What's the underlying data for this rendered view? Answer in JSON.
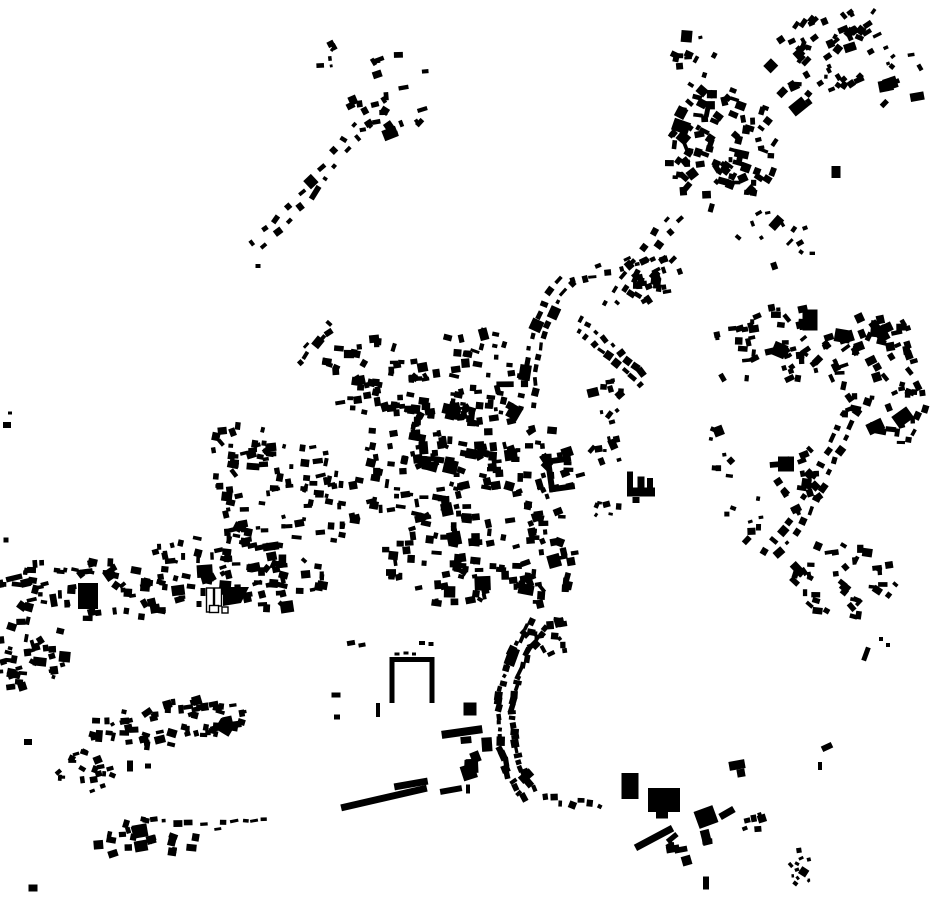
{
  "canvas": {
    "width": 930,
    "height": 924,
    "background": "#ffffff"
  },
  "colors": {
    "building": "#000000",
    "outline_fill": "#ffffff",
    "outline_stroke": "#000000"
  },
  "map": {
    "seed": 42,
    "blob_fields": [
      "cx",
      "cy",
      "rx",
      "ry",
      "count",
      "size",
      "grain_deg",
      "jitter_deg",
      "ellipse_rot_deg"
    ],
    "blobs": [
      [
        392,
        100,
        42,
        48,
        26,
        6,
        -20,
        25,
        20
      ],
      [
        327,
        57,
        12,
        18,
        6,
        4.5,
        -20,
        25,
        0
      ],
      [
        695,
        58,
        22,
        30,
        12,
        5,
        10,
        25,
        0
      ],
      [
        722,
        148,
        58,
        62,
        95,
        6,
        15,
        28,
        10
      ],
      [
        818,
        60,
        52,
        46,
        48,
        6,
        -40,
        20,
        -40
      ],
      [
        858,
        28,
        26,
        20,
        14,
        5.5,
        -40,
        18,
        -40
      ],
      [
        893,
        72,
        32,
        38,
        12,
        5,
        -30,
        25,
        0
      ],
      [
        775,
        240,
        45,
        35,
        12,
        5,
        -30,
        30,
        0
      ],
      [
        652,
        280,
        32,
        28,
        26,
        6,
        -20,
        30,
        0
      ],
      [
        600,
        390,
        25,
        30,
        12,
        5,
        -25,
        30,
        0
      ],
      [
        605,
        452,
        16,
        20,
        8,
        5,
        -20,
        30,
        0
      ],
      [
        606,
        508,
        14,
        10,
        6,
        4.5,
        0,
        30,
        0
      ],
      [
        770,
        348,
        62,
        42,
        50,
        6,
        -15,
        25,
        -12
      ],
      [
        878,
        372,
        50,
        60,
        60,
        6.5,
        -10,
        30,
        0
      ],
      [
        912,
        425,
        16,
        30,
        8,
        5.5,
        0,
        25,
        0
      ],
      [
        800,
        480,
        30,
        35,
        20,
        6,
        -20,
        30,
        0
      ],
      [
        845,
        578,
        52,
        40,
        42,
        6,
        20,
        30,
        0
      ],
      [
        742,
        505,
        22,
        38,
        9,
        5,
        0,
        25,
        0
      ],
      [
        722,
        448,
        20,
        22,
        7,
        4.5,
        0,
        30,
        0
      ],
      [
        382,
        378,
        62,
        40,
        55,
        6,
        0,
        14,
        5
      ],
      [
        488,
        392,
        42,
        36,
        38,
        6,
        0,
        14,
        0
      ],
      [
        475,
        345,
        40,
        16,
        12,
        5.5,
        0,
        20,
        0
      ],
      [
        428,
        462,
        76,
        62,
        120,
        6,
        0,
        14,
        0
      ],
      [
        286,
        498,
        78,
        58,
        95,
        6,
        0,
        14,
        0
      ],
      [
        246,
        445,
        40,
        22,
        18,
        5.5,
        0,
        16,
        0
      ],
      [
        462,
        556,
        78,
        50,
        80,
        6,
        0,
        14,
        0
      ],
      [
        540,
        470,
        42,
        55,
        45,
        6,
        -8,
        16,
        0
      ],
      [
        545,
        560,
        35,
        45,
        35,
        6,
        -8,
        16,
        0
      ],
      [
        552,
        638,
        24,
        20,
        14,
        6,
        -10,
        20,
        0
      ],
      [
        196,
        556,
        42,
        26,
        26,
        5.5,
        0,
        18,
        0
      ],
      [
        92,
        590,
        92,
        30,
        70,
        6,
        0,
        16,
        3
      ],
      [
        262,
        582,
        72,
        28,
        50,
        6,
        0,
        16,
        0
      ],
      [
        32,
        658,
        36,
        46,
        38,
        5.5,
        0,
        20,
        10
      ],
      [
        166,
        723,
        80,
        22,
        65,
        6,
        0,
        18,
        -6
      ],
      [
        86,
        770,
        28,
        22,
        20,
        5,
        0,
        25,
        0
      ],
      [
        150,
        838,
        55,
        20,
        26,
        6,
        0,
        25,
        -4
      ],
      [
        474,
        755,
        16,
        19,
        7,
        10,
        0,
        10,
        0
      ],
      [
        753,
        822,
        16,
        12,
        6,
        6,
        -20,
        20,
        0
      ],
      [
        690,
        845,
        22,
        16,
        8,
        8,
        -20,
        20,
        0
      ],
      [
        802,
        866,
        12,
        22,
        12,
        3.5,
        -30,
        30,
        10
      ]
    ],
    "string_fields": [
      "pts",
      "n",
      "s",
      "rows",
      "off"
    ],
    "strings": [
      {
        "pts": [
          [
            252,
            250
          ],
          [
            282,
            220
          ],
          [
            310,
            190
          ],
          [
            340,
            152
          ],
          [
            368,
            118
          ]
        ],
        "n": 20,
        "s": 5.5,
        "rows": 2,
        "off": 5
      },
      {
        "pts": [
          [
            678,
            212
          ],
          [
            650,
            248
          ],
          [
            622,
            286
          ],
          [
            607,
            310
          ]
        ],
        "n": 14,
        "s": 5.5,
        "rows": 2,
        "off": 5
      },
      {
        "pts": [
          [
            527,
            412
          ],
          [
            530,
            372
          ],
          [
            540,
            330
          ],
          [
            553,
            298
          ],
          [
            568,
            278
          ]
        ],
        "n": 24,
        "s": 5.5,
        "rows": 2,
        "off": 5.5
      },
      {
        "pts": [
          [
            568,
            278
          ],
          [
            600,
            270
          ],
          [
            632,
            262
          ],
          [
            658,
            252
          ]
        ],
        "n": 10,
        "s": 5,
        "rows": 1,
        "off": 4
      },
      {
        "pts": [
          [
            575,
            322
          ],
          [
            600,
            342
          ],
          [
            622,
            362
          ],
          [
            645,
            382
          ]
        ],
        "n": 18,
        "s": 5.5,
        "rows": 2,
        "off": 5
      },
      {
        "pts": [
          [
            852,
            408
          ],
          [
            835,
            448
          ],
          [
            815,
            490
          ],
          [
            793,
            527
          ],
          [
            768,
            558
          ]
        ],
        "n": 26,
        "s": 6,
        "rows": 2,
        "off": 5.5
      },
      {
        "pts": [
          [
            540,
            622
          ],
          [
            522,
            648
          ],
          [
            510,
            680
          ],
          [
            505,
            712
          ],
          [
            507,
            745
          ],
          [
            516,
            775
          ],
          [
            530,
            796
          ]
        ],
        "n": 58,
        "s": 6,
        "rows": 2,
        "off": 7
      },
      {
        "pts": [
          [
            540,
            800
          ],
          [
            562,
            800
          ],
          [
            584,
            804
          ],
          [
            602,
            810
          ]
        ],
        "n": 7,
        "s": 5,
        "rows": 1,
        "off": 3
      },
      {
        "pts": [
          [
            200,
            827
          ],
          [
            222,
            825
          ],
          [
            244,
            824
          ],
          [
            268,
            822
          ]
        ],
        "n": 7,
        "s": 5,
        "rows": 1,
        "off": 3
      },
      {
        "pts": [
          [
            296,
            362
          ],
          [
            316,
            340
          ],
          [
            336,
            322
          ]
        ],
        "n": 7,
        "s": 5,
        "rows": 1,
        "off": 3
      }
    ],
    "extra_fields": [
      "cx",
      "cy",
      "w",
      "h",
      "rot_deg"
    ],
    "extras": [
      [
        10,
        413,
        4,
        3,
        0
      ],
      [
        7,
        425,
        8,
        6,
        0
      ],
      [
        6,
        540,
        5,
        5,
        0
      ],
      [
        28,
        742,
        8,
        6,
        0
      ],
      [
        33,
        888,
        9,
        7,
        0
      ],
      [
        130,
        766,
        6,
        11,
        0
      ],
      [
        148,
        766,
        6,
        5,
        0
      ],
      [
        258,
        266,
        5,
        4,
        0
      ],
      [
        805,
        228,
        5,
        4,
        -20
      ],
      [
        800,
        243,
        7,
        5,
        -30
      ],
      [
        336,
        695,
        9,
        5,
        0
      ],
      [
        378,
        710,
        4,
        14,
        0
      ],
      [
        337,
        717,
        6,
        5,
        0
      ],
      [
        351,
        643,
        8,
        5,
        -10
      ],
      [
        362,
        645,
        7,
        4,
        -10
      ],
      [
        422,
        643,
        6,
        4,
        0
      ],
      [
        431,
        644,
        5,
        4,
        0
      ],
      [
        468,
        789,
        4,
        9,
        0
      ],
      [
        612,
        422,
        6,
        4,
        -15
      ],
      [
        866,
        654,
        5,
        14,
        20
      ],
      [
        881,
        639,
        4,
        4,
        0
      ],
      [
        888,
        645,
        4,
        4,
        0
      ],
      [
        827,
        747,
        11,
        6,
        -25
      ],
      [
        820,
        766,
        4,
        8,
        0
      ],
      [
        706,
        883,
        6,
        13,
        0
      ],
      [
        203,
        592,
        5,
        8,
        0
      ],
      [
        199,
        604,
        5,
        6,
        0
      ],
      [
        397,
        654,
        5,
        3,
        0
      ],
      [
        406,
        653,
        5,
        3,
        0
      ],
      [
        414,
        654,
        4,
        3,
        0
      ]
    ],
    "landmarks": [
      {
        "t": "u",
        "cx": 560,
        "cy": 474,
        "w": 26,
        "h": 34,
        "th": 6,
        "rot": -8,
        "open": "right"
      },
      {
        "t": "u",
        "cx": 412,
        "cy": 680,
        "w": 45,
        "h": 46,
        "th": 5,
        "rot": 0,
        "open": "down"
      },
      {
        "t": "bar",
        "c": [
          88,
          596,
          20,
          26,
          0
        ]
      },
      {
        "t": "bar",
        "c": [
          140,
          831,
          15,
          13,
          -10
        ]
      },
      {
        "t": "bar",
        "c": [
          141,
          846,
          13,
          11,
          -10
        ]
      },
      {
        "t": "bar",
        "c": [
          810,
          320,
          15,
          21,
          0
        ]
      },
      {
        "t": "bar",
        "c": [
          786,
          464,
          16,
          15,
          0
        ]
      },
      {
        "t": "bar",
        "c": [
          836,
          172,
          9,
          12,
          0
        ]
      },
      {
        "t": "bar",
        "c": [
          470,
          709,
          13,
          13,
          0
        ]
      },
      {
        "t": "bar",
        "c": [
          462,
          732,
          41,
          8,
          -8
        ]
      },
      {
        "t": "bar",
        "c": [
          384,
          798,
          88,
          7,
          -13
        ]
      },
      {
        "t": "bar",
        "c": [
          411,
          784,
          34,
          7,
          -10
        ]
      },
      {
        "t": "bar",
        "c": [
          451,
          790,
          22,
          6,
          -10
        ]
      },
      {
        "t": "bar",
        "c": [
          630,
          786,
          17,
          26,
          0
        ]
      },
      {
        "t": "bar",
        "c": [
          664,
          800,
          32,
          24,
          0
        ]
      },
      {
        "t": "bar",
        "c": [
          662,
          815,
          12,
          7,
          0
        ]
      },
      {
        "t": "bar",
        "c": [
          654,
          838,
          42,
          7,
          -28
        ]
      },
      {
        "t": "bar",
        "c": [
          706,
          817,
          20,
          18,
          -20
        ]
      },
      {
        "t": "bar",
        "c": [
          727,
          813,
          16,
          7,
          -30
        ]
      },
      {
        "t": "bar",
        "c": [
          737,
          765,
          16,
          9,
          -10
        ]
      },
      {
        "t": "bar",
        "c": [
          741,
          773,
          8,
          8,
          -10
        ]
      },
      {
        "t": "bar",
        "c": [
          630,
          483,
          6,
          23,
          0
        ]
      },
      {
        "t": "bar",
        "c": [
          641,
          492,
          28,
          9,
          0
        ]
      },
      {
        "t": "bar",
        "c": [
          641,
          484,
          7,
          15,
          0
        ]
      },
      {
        "t": "bar",
        "c": [
          650,
          485,
          6,
          14,
          0
        ]
      },
      {
        "t": "bar",
        "c": [
          636,
          500,
          7,
          6,
          0
        ]
      },
      {
        "t": "obar",
        "c": [
          210,
          600,
          7,
          24
        ]
      },
      {
        "t": "obar",
        "c": [
          218,
          597,
          7,
          18
        ]
      },
      {
        "t": "obar",
        "c": [
          214,
          609,
          9,
          7
        ]
      },
      {
        "t": "obar",
        "c": [
          225,
          610,
          6,
          6
        ]
      },
      {
        "t": "poly",
        "pts": [
          [
            223,
            587
          ],
          [
            249,
            587
          ],
          [
            241,
            603
          ],
          [
            223,
            606
          ]
        ]
      }
    ]
  }
}
